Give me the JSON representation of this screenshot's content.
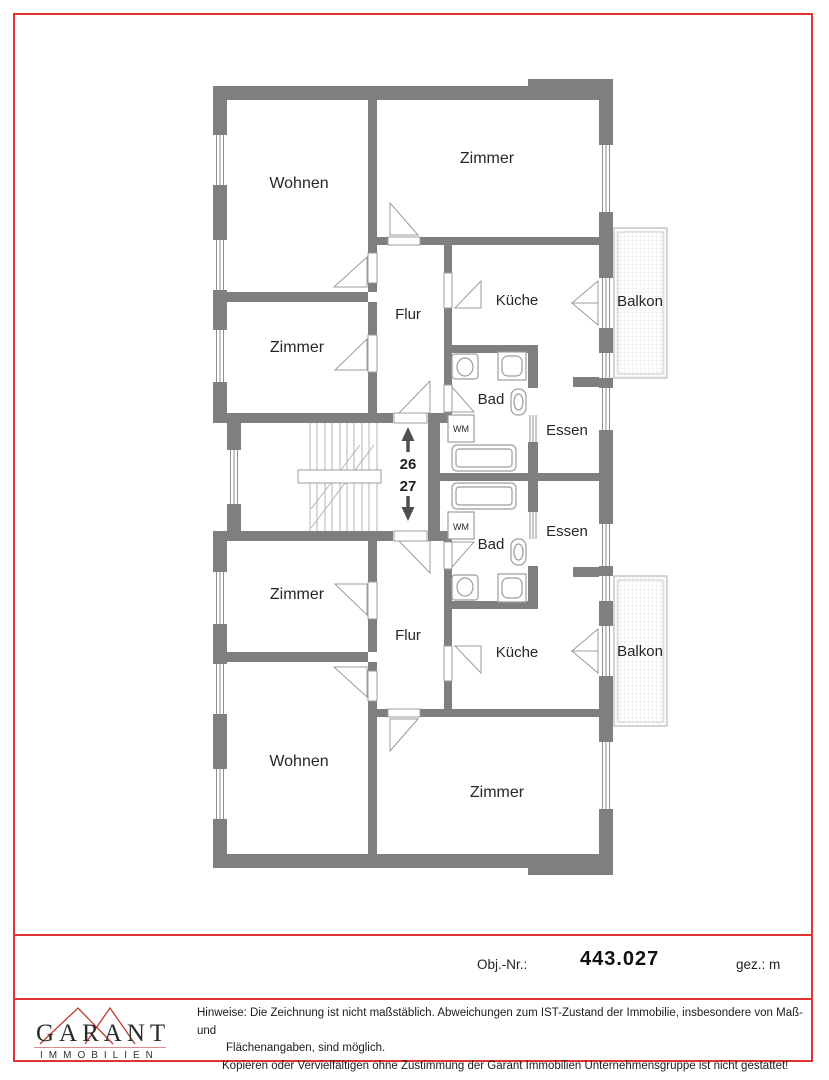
{
  "colors": {
    "frame_red": "#e23232",
    "wall_gray": "#7f7f7f",
    "logo_red": "#c0392b"
  },
  "plan": {
    "rooms": {
      "wohnen_top": "Wohnen",
      "zimmer_top": "Zimmer",
      "zimmer_left_top": "Zimmer",
      "flur_top": "Flur",
      "kueche_top": "Küche",
      "balkon_top": "Balkon",
      "bad_top": "Bad",
      "wm_top": "WM",
      "essen_top": "Essen",
      "essen_bottom": "Essen",
      "wm_bottom": "WM",
      "bad_bottom": "Bad",
      "zimmer_left_bottom": "Zimmer",
      "flur_bottom": "Flur",
      "kueche_bottom": "Küche",
      "balkon_bottom": "Balkon",
      "wohnen_bottom": "Wohnen",
      "zimmer_bottom": "Zimmer"
    },
    "stair": {
      "number_up": "26",
      "number_down": "27"
    }
  },
  "footer": {
    "obj_label": "Obj.-Nr.:",
    "obj_value": "443.027",
    "gez_label": "gez.: m"
  },
  "brand": {
    "name": "GARANT",
    "subtitle": "IMMOBILIEN"
  },
  "disclaimer": {
    "lines": [
      "Hinweise: Die Zeichnung ist nicht maßstäblich. Abweichungen zum IST-Zustand der Immobilie, insbesondere von Maß- und",
      "Flächenangaben, sind möglich.",
      "Kopieren oder Vervielfältigen ohne Zustimmung der Garant Immobilien Unternehmensgruppe ist nicht gestattet!"
    ]
  }
}
